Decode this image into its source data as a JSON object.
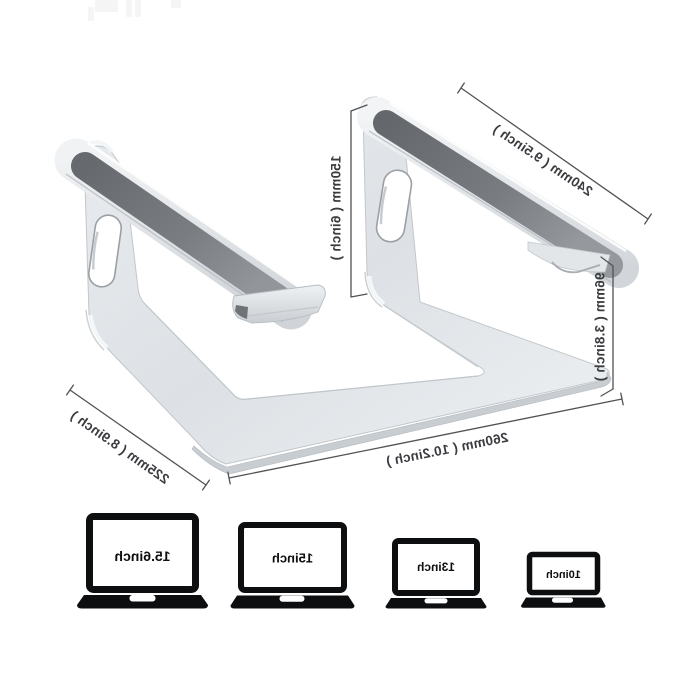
{
  "diagram": {
    "dimensions": [
      {
        "id": "platform-length",
        "label": "240mm ( 9.5inch )"
      },
      {
        "id": "stand-height",
        "label": "150mm ( 6inch )"
      },
      {
        "id": "lift-height",
        "label": "96mm ( 3.8inch )"
      },
      {
        "id": "base-length",
        "label": "260mm ( 10.2inch )"
      },
      {
        "id": "base-depth",
        "label": "225mm ( 8.9inch )"
      }
    ],
    "colors": {
      "aluminum": "#dde1e5",
      "aluminum_highlight": "#f7f9fa",
      "aluminum_shadow": "#c6cbd0",
      "rubber_pad": "#73767b",
      "annotation_line": "#515256",
      "label_text": "#3b3c40",
      "laptop_icon": "#0d0e0f",
      "background": "#ffffff"
    }
  },
  "compatibility": {
    "laptops": [
      {
        "label": "15.6inch"
      },
      {
        "label": "15inch"
      },
      {
        "label": "13inch"
      },
      {
        "label": "10inch"
      }
    ]
  }
}
